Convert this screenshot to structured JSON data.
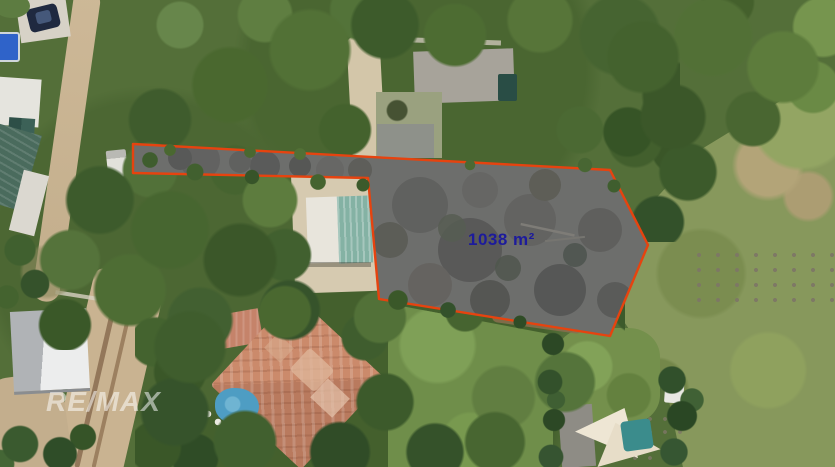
{
  "lot": {
    "area_label": "1038 m²",
    "area_value": 1038,
    "area_unit": "m²",
    "label_color": "#1d1b9c",
    "boundary_color": "#e6430f",
    "interior_color": "#8d897e",
    "overlay_tint": "rgba(44,52,70,0.32)",
    "polygon_points": [
      [
        133,
        144
      ],
      [
        610,
        170
      ],
      [
        648,
        245
      ],
      [
        610,
        336
      ],
      [
        379,
        299
      ],
      [
        368,
        178
      ],
      [
        133,
        173
      ]
    ]
  },
  "watermark": {
    "text": "RE/MAX",
    "color": "rgba(255,255,255,0.52)"
  }
}
